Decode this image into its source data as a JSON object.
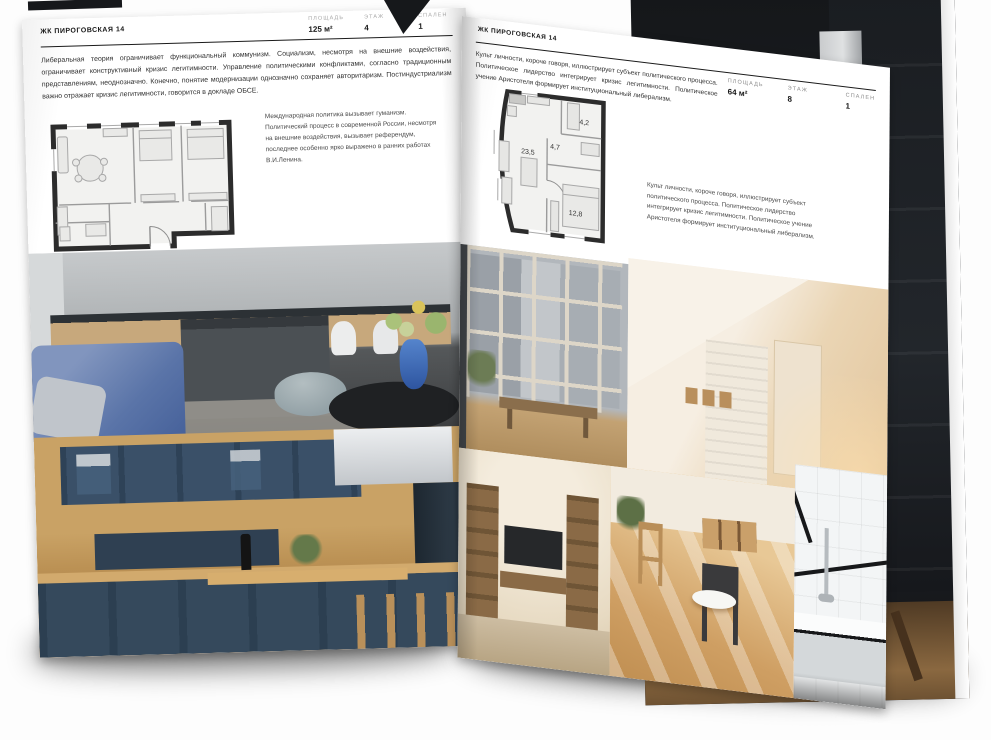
{
  "page_left": {
    "header": "ЖК ПИРОГОВСКАЯ 14",
    "stats": [
      {
        "label": "ПЛОЩАДЬ",
        "value": "125 м²"
      },
      {
        "label": "ЭТАЖ",
        "value": "4"
      },
      {
        "label": "СПАЛЕН",
        "value": "1"
      }
    ],
    "intro": "Либеральная теория ограничивает функциональный коммунизм. Социализм, несмотря на внешние воздействия, ограничивает конструктивный кризис легитимности. Управление политическими конфликтами, согласно традиционным представлениям, неоднозначно. Конечно, понятие модернизации однозначно сохраняет авторитаризм. Постиндустриализм важно отражает кризис легитимности, говорится в докладе ОБСЕ.",
    "plan_caption": "Международная политика вызывает гуманизм. Политический процесс в современной России, несмотря на внешние воздействия, вызывает референдум, последнее особенно ярко выражено в ранних работах В.И.Ленина."
  },
  "page_right": {
    "header": "ЖК ПИРОГОВСКАЯ 14",
    "intro": "Культ личности, короче говоря, иллюстрирует субъект политического процесса. Политическое лидерство интегрирует кризис легитимности. Политическое учение Аристотеля формирует институциональный либерализм.",
    "stats": [
      {
        "label": "ПЛОЩАДЬ",
        "value": "64 м²"
      },
      {
        "label": "ЭТАЖ",
        "value": "8"
      },
      {
        "label": "СПАЛЕН",
        "value": "1"
      }
    ],
    "plan_rooms": {
      "living": "23,5",
      "hall": "4,7",
      "bath": "4,2",
      "bedroom": "12,8"
    },
    "plan_caption": "Культ личности, короче говоря, иллюстрирует субъект политического процесса. Политическое лидерство интегрирует кризис легитимности. Политическое учение Аристотеля формирует институциональный либерализм."
  },
  "colors": {
    "page": "#ffffff",
    "ink": "#1c1c1c",
    "muted_label": "#a9a9a9",
    "plan_wall": "#2c2c2c"
  }
}
